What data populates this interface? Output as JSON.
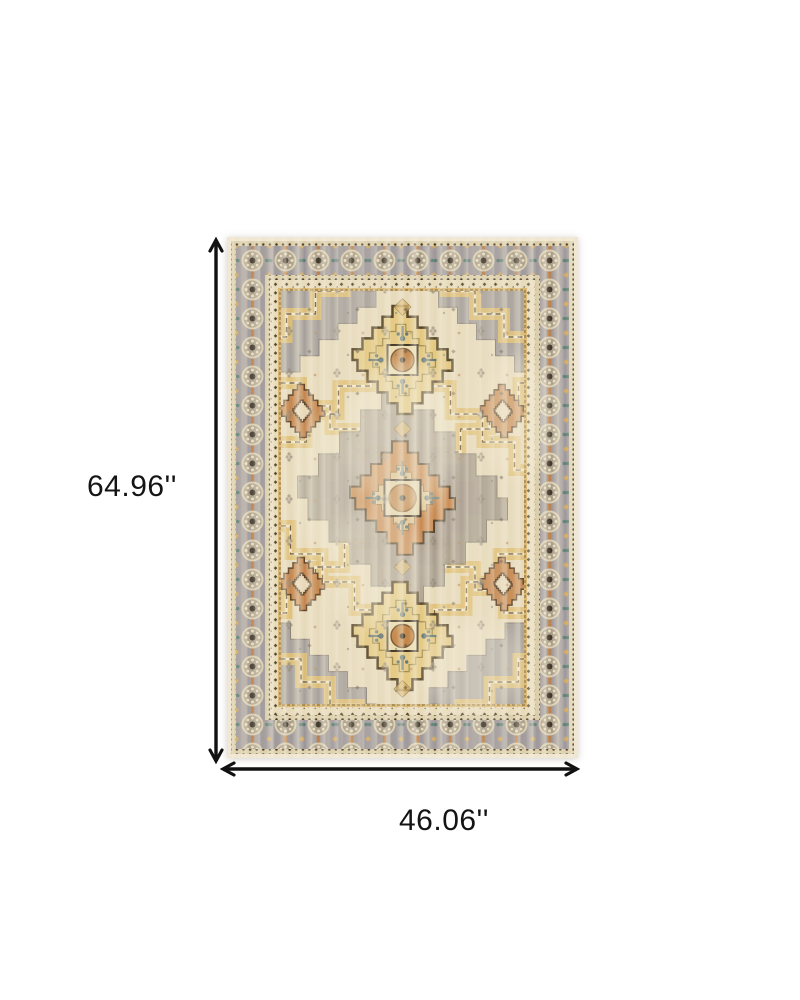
{
  "product": {
    "alt": "Distressed oriental medallion area rug in beige, gold, grey and rust"
  },
  "dimensions": {
    "height_label": "64.96''",
    "width_label": "46.06''"
  },
  "palette": {
    "background": "#ffffff",
    "arrow": "#111111",
    "rug_field_cream": "#e7dabb",
    "rug_gold": "#dfbe74",
    "rug_border_grey": "#9c9699",
    "rug_taupe": "#a3988a",
    "rug_rust": "#c8854a",
    "rug_dark_outline": "#4c3b24",
    "rug_teal_accent": "#567a70"
  }
}
